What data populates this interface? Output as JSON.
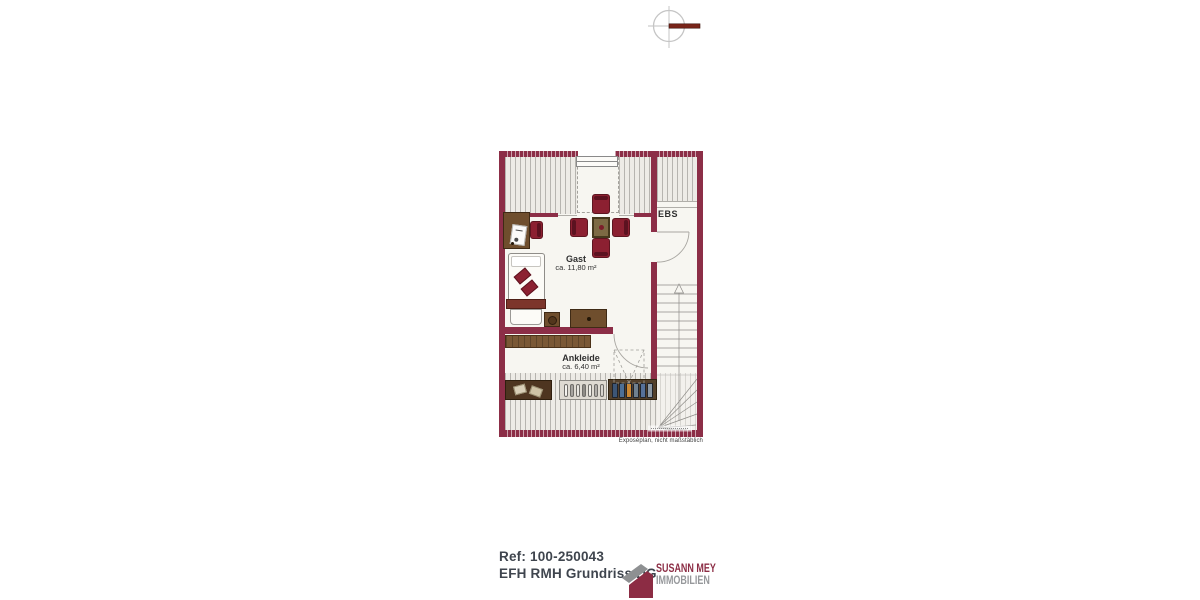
{
  "colors": {
    "wall": "#8c2e47",
    "furniture_red": "#8c2031",
    "brand_red": "#8c2d45",
    "brand_gray": "#96989b",
    "compass_needle": "#78251a"
  },
  "floorplan": {
    "rooms": [
      {
        "key": "gast",
        "label": "Gast",
        "area": "ca. 11,80 m²"
      },
      {
        "key": "ankleide",
        "label": "Ankleide",
        "area": "ca. 6,40 m²"
      },
      {
        "key": "ebs",
        "label": "EBS",
        "area": ""
      }
    ],
    "disclaimer": "Exposéplan, nicht maßstäblich"
  },
  "footer": {
    "reference": "Ref: 100-250043",
    "plan_title": "EFH RMH Grundriss DG",
    "brand": {
      "name_line1": "SUSANN MEY",
      "name_line2": "IMMOBILIEN"
    }
  }
}
